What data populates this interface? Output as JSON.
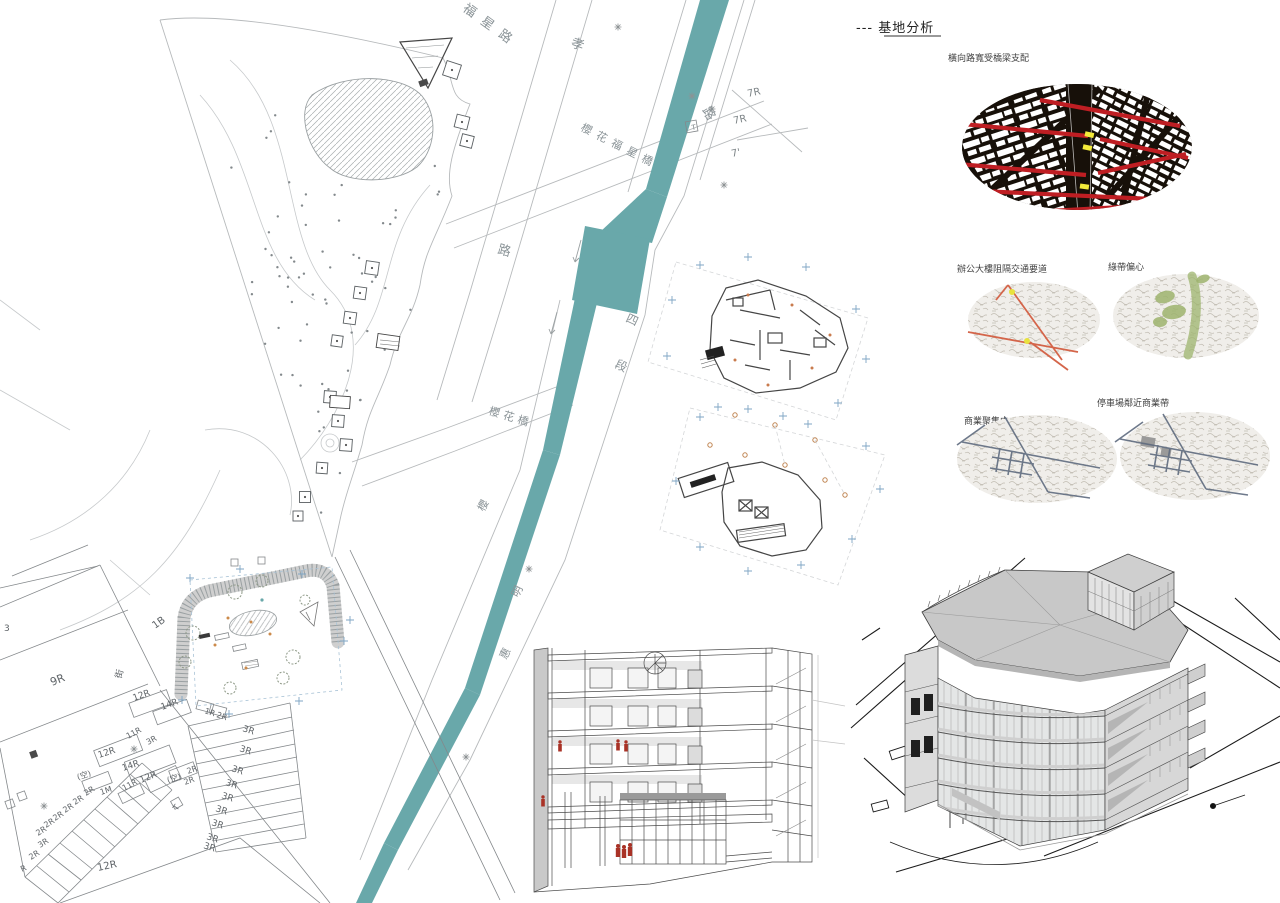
{
  "board": {
    "analysis": {
      "title": "--- 基地分析",
      "figure_ground_label": "橫向路寬受橋梁支配",
      "maps": [
        {
          "label": "辦公大樓阻隔交通要道"
        },
        {
          "label": "綠帶偏心"
        },
        {
          "label": "商業聚集中"
        },
        {
          "label": "停車場鄰近商業帶"
        }
      ],
      "colors": {
        "road_red": "#bf1e23",
        "bridge_yellow": "#f3ea3a",
        "traffic_orange": "#d4654a",
        "green_belt": "#9eb46e",
        "road_slate": "#5e6a7e"
      }
    },
    "site_plan": {
      "river_color": "#69a8aa",
      "street_labels": [
        {
          "t": "福星路",
          "x": 462,
          "y": 10,
          "r": 36,
          "s": 13,
          "ls": 9
        },
        {
          "t": "孝",
          "x": 570,
          "y": 46,
          "r": 20,
          "s": 13
        },
        {
          "t": "路",
          "x": 702,
          "y": 110,
          "r": 60,
          "s": 13
        },
        {
          "t": "櫻花福星橋",
          "x": 580,
          "y": 130,
          "r": 27,
          "s": 11,
          "ls": 6
        },
        {
          "t": "路",
          "x": 497,
          "y": 253,
          "r": 15,
          "s": 13
        },
        {
          "t": "四",
          "x": 625,
          "y": 321,
          "r": 25,
          "s": 12
        },
        {
          "t": "段",
          "x": 614,
          "y": 367,
          "r": 25,
          "s": 12
        },
        {
          "t": "櫻花橋",
          "x": 488,
          "y": 414,
          "r": 17,
          "s": 11,
          "ls": 4
        },
        {
          "t": "櫻",
          "x": 484,
          "y": 512,
          "r": -63,
          "s": 11
        },
        {
          "t": "明",
          "x": 518,
          "y": 598,
          "r": -63,
          "s": 11
        },
        {
          "t": "惠",
          "x": 506,
          "y": 660,
          "r": -63,
          "s": 11
        }
      ],
      "annotations": [
        {
          "t": "7R",
          "x": 748,
          "y": 97,
          "r": -12,
          "s": 10
        },
        {
          "t": "7R",
          "x": 734,
          "y": 124,
          "r": -12,
          "s": 10
        },
        {
          "t": "7'",
          "x": 732,
          "y": 157,
          "r": -12,
          "s": 10
        },
        {
          "t": "T",
          "x": 692,
          "y": 130,
          "r": -10,
          "s": 7
        }
      ]
    },
    "cadastral": {
      "lots": [
        {
          "t": "9R",
          "x": 52,
          "y": 686,
          "r": -22,
          "s": 11
        },
        {
          "t": "1B",
          "x": 155,
          "y": 629,
          "r": -35,
          "s": 10
        },
        {
          "t": "街",
          "x": 121,
          "y": 679,
          "r": -75,
          "s": 9
        },
        {
          "t": "3",
          "x": 4,
          "y": 631,
          "r": 0,
          "s": 9
        },
        {
          "t": "12R",
          "x": 134,
          "y": 701,
          "r": -20,
          "s": 9
        },
        {
          "t": "14R",
          "x": 162,
          "y": 710,
          "r": -20,
          "s": 9
        },
        {
          "t": "11R",
          "x": 128,
          "y": 739,
          "r": -28,
          "s": 8
        },
        {
          "t": "3R",
          "x": 148,
          "y": 745,
          "r": -28,
          "s": 8
        },
        {
          "t": "12R",
          "x": 99,
          "y": 758,
          "r": -18,
          "s": 9
        },
        {
          "t": "14R",
          "x": 123,
          "y": 771,
          "r": -18,
          "s": 9
        },
        {
          "t": "12R",
          "x": 141,
          "y": 783,
          "r": -22,
          "s": 9
        },
        {
          "t": "11R",
          "x": 124,
          "y": 791,
          "r": -28,
          "s": 8
        },
        {
          "t": "1M",
          "x": 101,
          "y": 795,
          "r": -18,
          "s": 8
        },
        {
          "t": "(空)",
          "x": 78,
          "y": 780,
          "r": -18,
          "s": 8
        },
        {
          "t": "(空)",
          "x": 168,
          "y": 783,
          "r": -18,
          "s": 8
        },
        {
          "t": "2R",
          "x": 188,
          "y": 774,
          "r": -20,
          "s": 8
        },
        {
          "t": "2R",
          "x": 185,
          "y": 785,
          "r": -20,
          "s": 8
        },
        {
          "t": "T",
          "x": 177,
          "y": 811,
          "r": -55,
          "s": 8
        },
        {
          "t": "2R",
          "x": 86,
          "y": 796,
          "r": -32,
          "s": 8
        },
        {
          "t": "2R",
          "x": 75,
          "y": 805,
          "r": -32,
          "s": 8
        },
        {
          "t": "2R",
          "x": 65,
          "y": 813,
          "r": -32,
          "s": 8
        },
        {
          "t": "2R",
          "x": 55,
          "y": 821,
          "r": -32,
          "s": 8
        },
        {
          "t": "2R",
          "x": 46,
          "y": 828,
          "r": -32,
          "s": 8
        },
        {
          "t": "2R",
          "x": 38,
          "y": 836,
          "r": -32,
          "s": 8
        },
        {
          "t": "3R",
          "x": 40,
          "y": 848,
          "r": -32,
          "s": 8
        },
        {
          "t": "2R",
          "x": 31,
          "y": 860,
          "r": -32,
          "s": 8
        },
        {
          "t": "R",
          "x": 22,
          "y": 872,
          "r": -25,
          "s": 8
        },
        {
          "t": "12R",
          "x": 98,
          "y": 871,
          "r": -12,
          "s": 10
        },
        {
          "t": "1R",
          "x": 204,
          "y": 713,
          "r": 18,
          "s": 8
        },
        {
          "t": "2R",
          "x": 216,
          "y": 717,
          "r": 18,
          "s": 8
        },
        {
          "t": "3R",
          "x": 242,
          "y": 731,
          "r": 18,
          "s": 9
        },
        {
          "t": "3R",
          "x": 239,
          "y": 751,
          "r": 18,
          "s": 9
        },
        {
          "t": "3R",
          "x": 231,
          "y": 771,
          "r": 18,
          "s": 9
        },
        {
          "t": "3R",
          "x": 225,
          "y": 785,
          "r": 18,
          "s": 9
        },
        {
          "t": "3R",
          "x": 221,
          "y": 798,
          "r": 18,
          "s": 9
        },
        {
          "t": "3R",
          "x": 215,
          "y": 811,
          "r": 18,
          "s": 9
        },
        {
          "t": "3R",
          "x": 211,
          "y": 825,
          "r": 18,
          "s": 9
        },
        {
          "t": "3R",
          "x": 206,
          "y": 839,
          "r": 18,
          "s": 9
        },
        {
          "t": "3R",
          "x": 203,
          "y": 848,
          "r": 18,
          "s": 9
        }
      ]
    }
  }
}
